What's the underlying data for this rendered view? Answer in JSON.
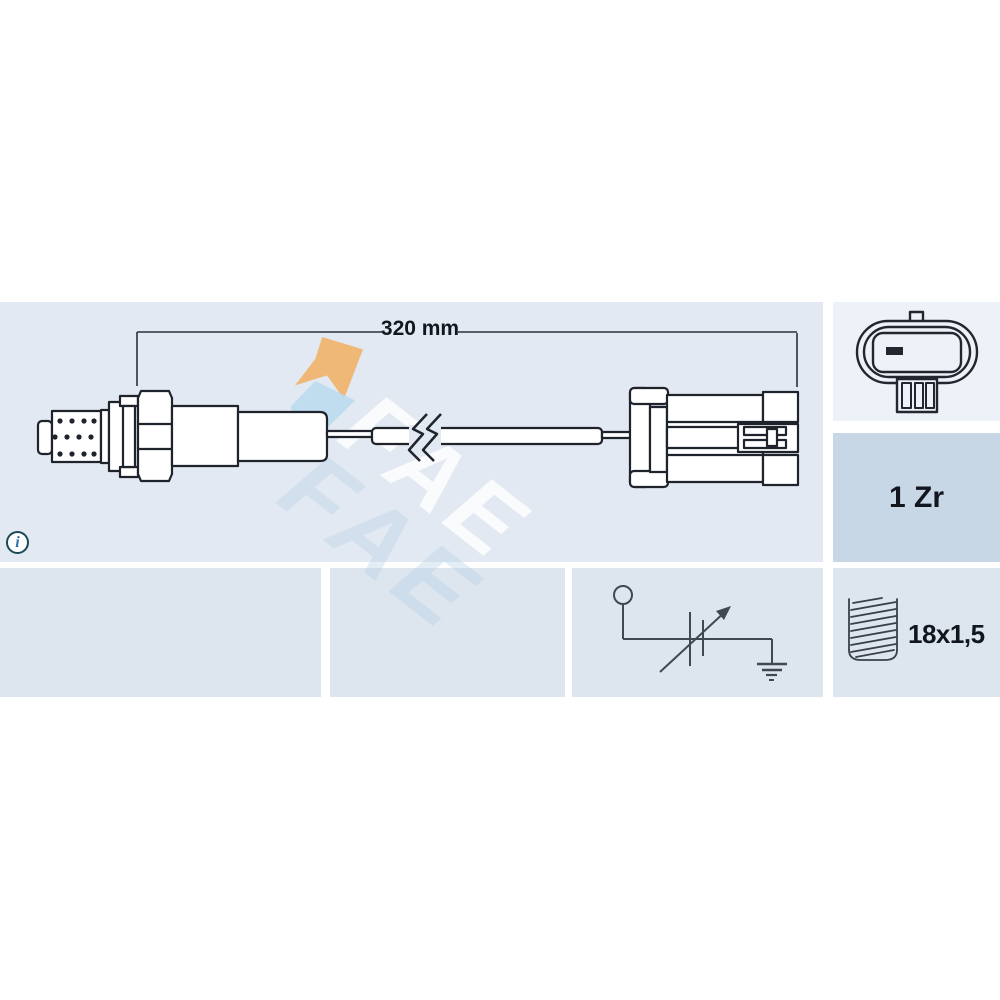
{
  "diagram": {
    "dimension_label": "320 mm",
    "watermark_text": "FAE",
    "info_symbol": "i"
  },
  "specs": {
    "sensor_type_label": "1 Zr",
    "thread_size_label": "18x1,5"
  },
  "colors": {
    "panel_main": "#e3e9f2",
    "panel_face": "#edf2f8",
    "panel_type": "#c8d7e6",
    "panel_row2": "#dde5ee",
    "ink": "#1f232b",
    "schematic_ink": "#424754",
    "text": "#12161f",
    "info_ring": "#1c4956",
    "info_glyph": "#2e6fae",
    "watermark_orange": "#f1b36b",
    "watermark_blue": "#badbed"
  }
}
